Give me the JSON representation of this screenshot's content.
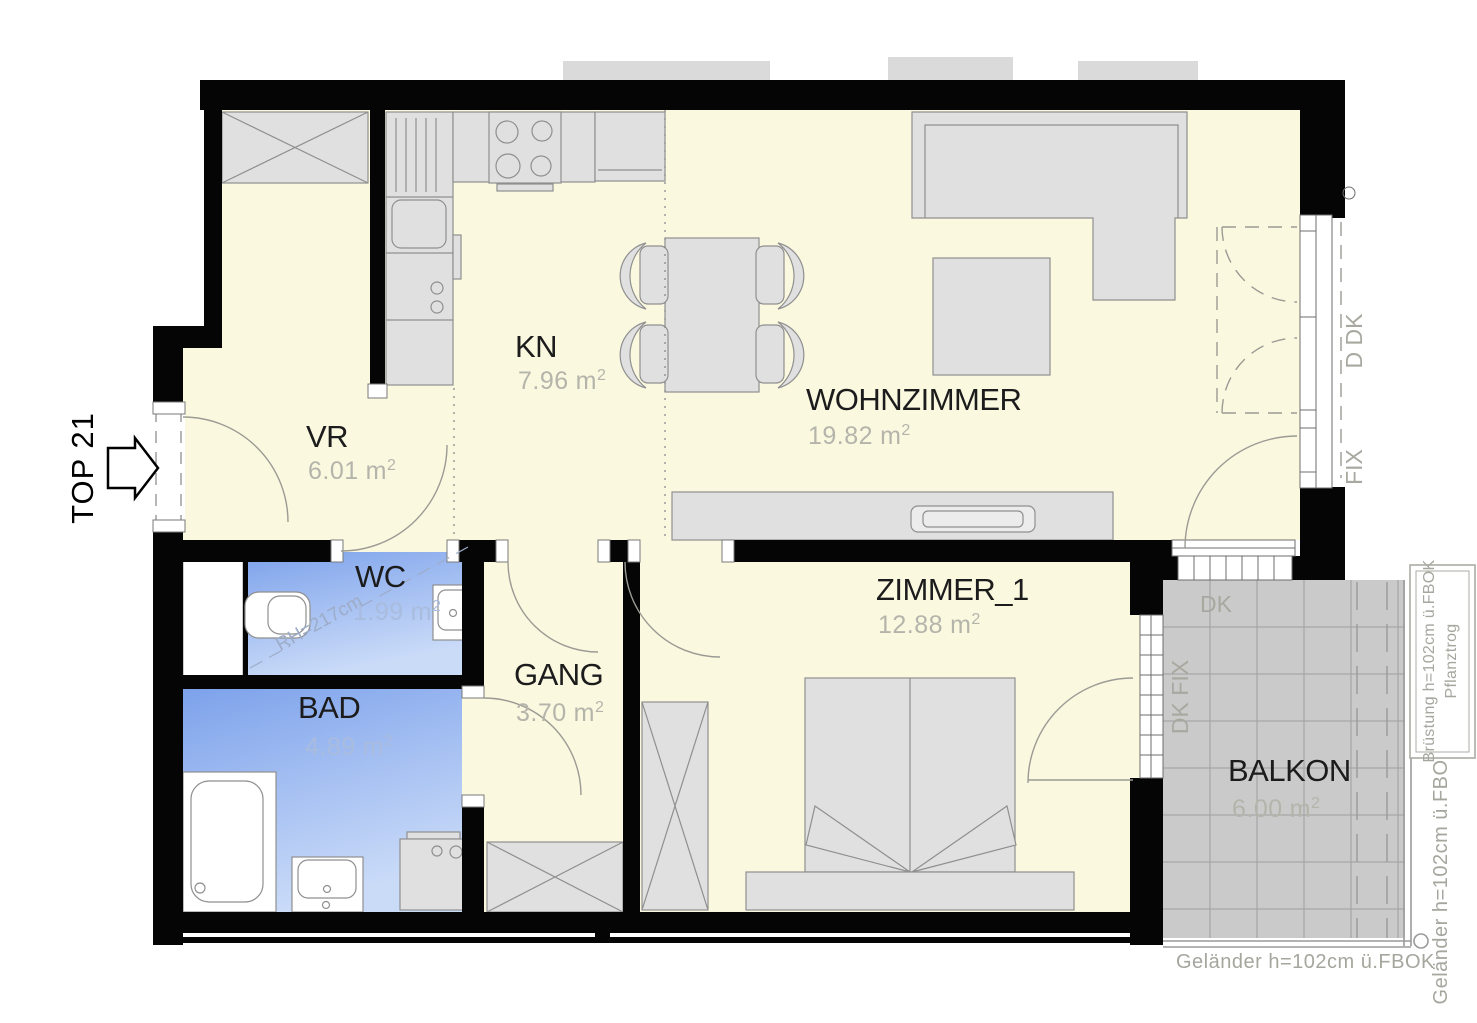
{
  "title": "TOP 21",
  "area_unit": {
    "base": "m",
    "sup": "2"
  },
  "rooms": [
    {
      "id": "vr",
      "name": "VR",
      "area": "6.01"
    },
    {
      "id": "kn",
      "name": "KN",
      "area": "7.96"
    },
    {
      "id": "wohnzimmer",
      "name": "WOHNZIMMER",
      "area": "19.82"
    },
    {
      "id": "wc",
      "name": "WC",
      "area": "1.99"
    },
    {
      "id": "bad",
      "name": "BAD",
      "area": "4.89"
    },
    {
      "id": "gang",
      "name": "GANG",
      "area": "3.70"
    },
    {
      "id": "zimmer_1",
      "name": "ZIMMER_1",
      "area": "12.88"
    },
    {
      "id": "balkon",
      "name": "BALKON",
      "area": "6.00"
    }
  ],
  "annotations": {
    "wc_room_height": "RH=217cm",
    "window_right_upper": "D DK",
    "window_right_lower": "FIX",
    "balcony_dk": "DK",
    "balcony_window": "DK FIX",
    "planter_line1": "Brüstung h=102cm ü.FBOK",
    "planter_line2": "Pflanztrog",
    "railing_side": "Geländer  h=102cm  ü.FBOK",
    "railing_bottom": "Geländer  h=102cm  ü.FBOK"
  },
  "colors": {
    "wall": "#050505",
    "room_fill": "#FBF8E0",
    "wet_room_gradient_top": "#7DA2EB",
    "wet_room_gradient_bottom": "#CADBF8",
    "balcony_fill": "#CACACA",
    "furniture_fill": "#E0E0E0",
    "furniture_stroke": "#8F8F8F",
    "area_text": "#B4B4AB",
    "annotation_text": "#A6A69E"
  }
}
